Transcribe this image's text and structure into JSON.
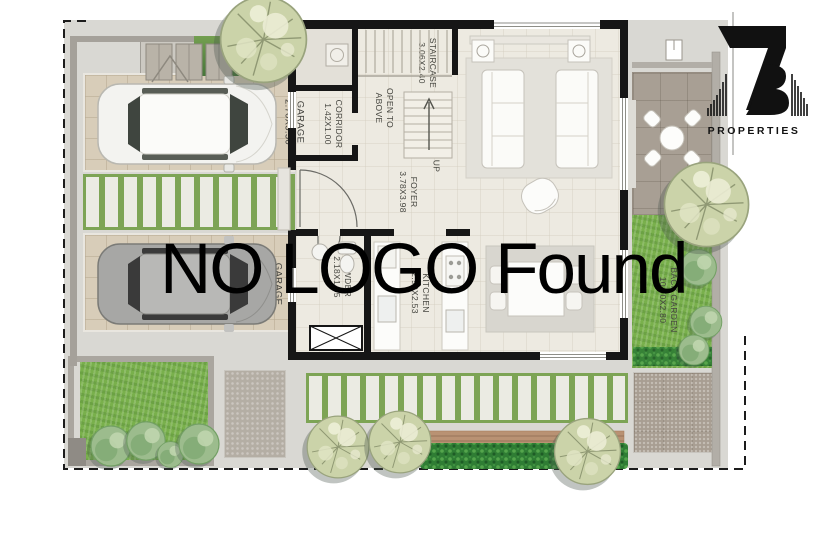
{
  "watermark": {
    "text": "NO LOGO Found"
  },
  "brand": {
    "name": "PROPERTIES"
  },
  "plan": {
    "rooms": [
      {
        "key": "garage-1",
        "name": "GARAGE",
        "dims": "2.70X5.50"
      },
      {
        "key": "garage-2",
        "name": "GARAGE",
        "dims": "3.03X5.50"
      },
      {
        "key": "laundry",
        "name": "LAUN.",
        "dims": "1.30X1.00"
      },
      {
        "key": "corridor",
        "name": "CORRIDOR",
        "dims": "1.42X1.00"
      },
      {
        "key": "staircase",
        "name": "STAIRCASE",
        "dims": "3.06X2.40"
      },
      {
        "key": "open-to-above",
        "name": "OPEN TO ABOVE",
        "dims": ""
      },
      {
        "key": "up",
        "name": "UP",
        "dims": ""
      },
      {
        "key": "foyer",
        "name": "FOYER",
        "dims": "3.78X3.98"
      },
      {
        "key": "living-room",
        "name": "LIVING ROOM",
        "dims": "4.85x3.85"
      },
      {
        "key": "powder",
        "name": "POWDER",
        "dims": "2.18X1.55"
      },
      {
        "key": "kitchen",
        "name": "KITCHEN",
        "dims": "2.99X2.53"
      },
      {
        "key": "dining-room",
        "name": "DINING ROOM",
        "dims": "2.90X3.43"
      },
      {
        "key": "back-garden",
        "name": "BACK GARDEN",
        "dims": "10.70X2.80"
      }
    ]
  }
}
